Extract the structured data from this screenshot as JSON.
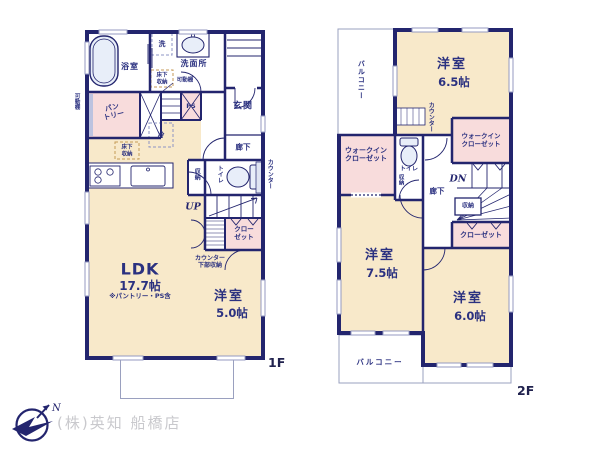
{
  "floor1": {
    "tag": "1F",
    "bath": "浴室",
    "washer": "洗",
    "washroom": "洗面所",
    "underfloor_wash_l1": "床下",
    "underfloor_wash_l2": "収納",
    "movable_shelf_mid": "可動棚",
    "movable_shelf_left": "可動棚",
    "pantry_l1": "パン",
    "pantry_l2": "トリー",
    "ps": "PS",
    "fridge": "冷",
    "underfloor_kitchen_l1": "床下",
    "underfloor_kitchen_l2": "収納",
    "genkan": "玄関",
    "hallway": "廊下",
    "storage": "収納",
    "toilet": "トイレ",
    "counter": "カウンター",
    "up": "UP",
    "closet_l1": "クロー",
    "closet_l2": "ゼット",
    "counter_storage_l1": "カウンター",
    "counter_storage_l2": "下部収納",
    "ldk": "LDK",
    "ldk_size": "17.7帖",
    "ldk_note": "※パントリー・PS含",
    "bedroom5_name": "洋室",
    "bedroom5_size": "5.0帖"
  },
  "floor2": {
    "tag": "2F",
    "balcony_top": "バルコニー",
    "bedroom65_name": "洋室",
    "bedroom65_size": "6.5帖",
    "counter": "カウンター",
    "wic_left_l1": "ウォークイン",
    "wic_left_l2": "クローゼット",
    "wic_right_l1": "ウォークイン",
    "wic_right_l2": "クローゼット",
    "toilet": "トイレ",
    "toilet_storage": "収納",
    "hallway": "廊下",
    "dn": "DN",
    "stairs_storage": "収納",
    "closet": "クローゼット",
    "bedroom75_name": "洋室",
    "bedroom75_size": "7.5帖",
    "bedroom60_name": "洋室",
    "bedroom60_size": "6.0帖",
    "balcony_bottom": "バルコニー"
  },
  "footer": {
    "company": "(株)英知 船橋店",
    "north": "N"
  },
  "colors": {
    "wall": "#23256e",
    "room_fill": "#f8e9ca",
    "closet_fill": "#f8dcdc",
    "text": "#2b3180"
  }
}
